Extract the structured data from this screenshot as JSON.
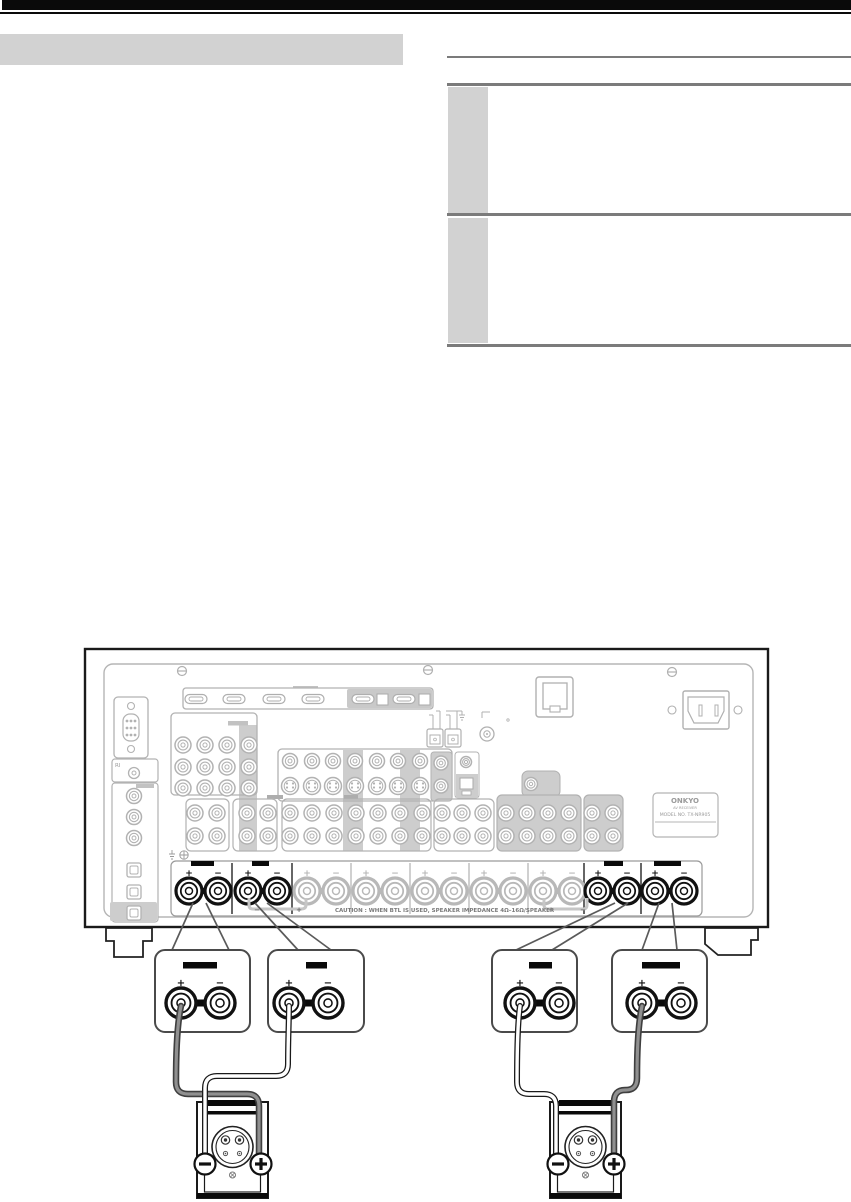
{
  "page": {
    "heading_placeholder": "",
    "table": {
      "header": "",
      "row1_label": "",
      "row1_text": "",
      "row2_label": "",
      "row2_text": ""
    }
  },
  "diagram": {
    "plus": "+",
    "minus": "−",
    "ri_label": "RI",
    "caution_text": "CAUTION : WHEN BTL IS USED, SPEAKER IMPEDANCE  4Ω–16Ω/SPEAKER",
    "brand": {
      "name": "ONKYO",
      "subtitle": "AV RECEIVER",
      "model": "MODEL NO. TX-NR905"
    },
    "speaker_pairs": [
      {
        "highlighted": true
      },
      {
        "highlighted": true
      },
      {
        "highlighted": false
      },
      {
        "highlighted": false
      },
      {
        "highlighted": false
      },
      {
        "highlighted": false
      },
      {
        "highlighted": false
      },
      {
        "highlighted": true
      },
      {
        "highlighted": true
      }
    ],
    "bridge_left": {
      "left_sign": "−",
      "right_sign": "+"
    },
    "bridge_right": {
      "left_sign": "+",
      "right_sign": "−"
    },
    "terminal_boxes": [
      {
        "plus": "+",
        "minus": "−"
      },
      {
        "plus": "+",
        "minus": "−"
      },
      {
        "plus": "+",
        "minus": "−"
      },
      {
        "plus": "+",
        "minus": "−"
      }
    ],
    "speakers": [
      {
        "minus_badge": "−",
        "plus_badge": "+"
      },
      {
        "minus_badge": "−",
        "plus_badge": "+"
      }
    ]
  }
}
